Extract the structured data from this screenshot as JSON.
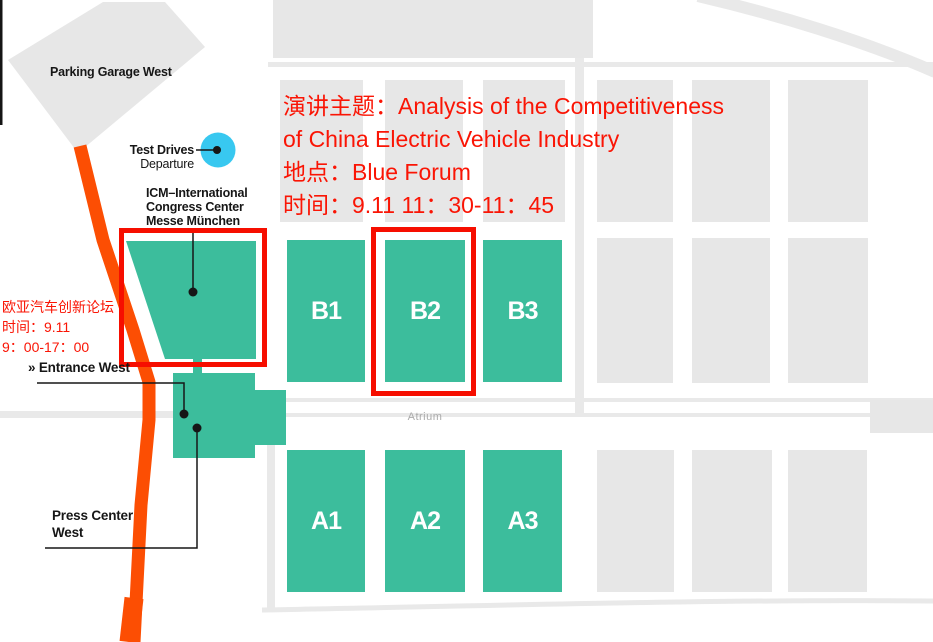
{
  "colors": {
    "hall": "#3CBD9C",
    "block": "#E7E7E7",
    "road": "#E9E9E9",
    "orange": "#FC4E03",
    "red": "#FA1505",
    "redline": "#F60E00",
    "cyan": "#38C8F0",
    "ink": "#161616",
    "atrium": "#ABABAB"
  },
  "annotation": {
    "line1": "演讲主题：Analysis of the Competitiveness",
    "line2": "of China Electric Vehicle Industry",
    "line3": "地点：Blue Forum",
    "line4": "时间：9.11 11：30-11：45"
  },
  "forum_note": {
    "line1": "欧亚汽车创新论坛",
    "line2": "时间：9.11",
    "line3": "9：00-17：00"
  },
  "labels": {
    "parking": "Parking Garage West",
    "test_drives": "Test Drives",
    "departure": "Departure",
    "icm_line1": "ICM–International",
    "icm_line2": "Congress Center",
    "icm_line3": "Messe München",
    "entrance_west": "» Entrance West",
    "press_center_line1": "Press Center",
    "press_center_line2": "West",
    "atrium": "Atrium"
  },
  "halls": {
    "b": [
      "B1",
      "B2",
      "B3"
    ],
    "a": [
      "A1",
      "A2",
      "A3"
    ]
  }
}
